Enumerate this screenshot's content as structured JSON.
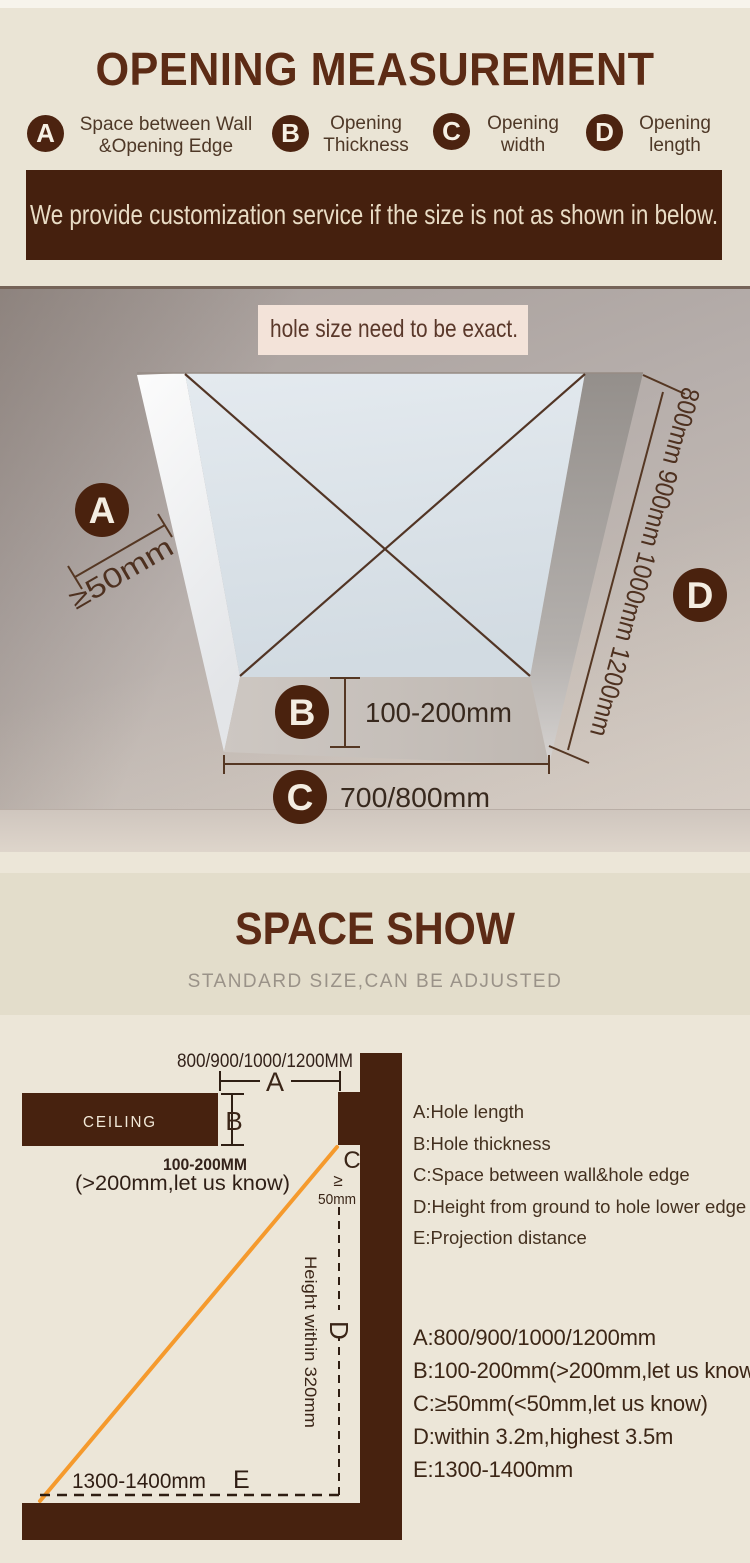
{
  "header": {
    "title": "OPENING MEASUREMENT",
    "legend": [
      {
        "key": "A",
        "line1": "Space between Wall",
        "line2": "&Opening Edge"
      },
      {
        "key": "B",
        "line1": "Opening",
        "line2": "Thickness"
      },
      {
        "key": "C",
        "line1": "Opening",
        "line2": "width"
      },
      {
        "key": "D",
        "line1": "Opening",
        "line2": "length"
      }
    ],
    "banner": "We provide customization service if the size is not as shown in below."
  },
  "illustration": {
    "note": "hole size need to be exact.",
    "marker_a": "A",
    "marker_b": "B",
    "marker_c": "C",
    "marker_d": "D",
    "a_value": "≥50mm",
    "b_value": "100-200mm",
    "c_value": "700/800mm",
    "d_value": "800mm 900mm 1000mm 1200mm"
  },
  "space_show": {
    "title": "SPACE SHOW",
    "subtitle": "STANDARD SIZE,CAN BE ADJUSTED",
    "diagram": {
      "top_dim": "800/900/1000/1200MM",
      "a": "A",
      "b": "B",
      "c": "C",
      "d": "D",
      "e": "E",
      "ceiling": "CEILING",
      "b_dim": "100-200MM",
      "b_note": "(>200mm,let us know)",
      "c_gte": "≥",
      "c_dim": "50mm",
      "height_note": "Height within 320mm",
      "e_dim": "1300-1400mm"
    },
    "legend_definitions": [
      "A:Hole length",
      "B:Hole thickness",
      "C:Space between wall&hole edge",
      "D:Height from ground to hole lower edge",
      "E:Projection distance"
    ],
    "legend_values": [
      "A:800/900/1000/1200mm",
      "B:100-200mm(>200mm,let us know)",
      "C:≥50mm(<50mm,let us know)",
      "D:within 3.2m,highest 3.5m",
      "E:1300-1400mm"
    ]
  },
  "colors": {
    "accent_brown": "#47220f",
    "banner_brown": "#45200e",
    "cream": "#eae4d5",
    "orange": "#f59a2d",
    "line_brown": "#543723"
  }
}
